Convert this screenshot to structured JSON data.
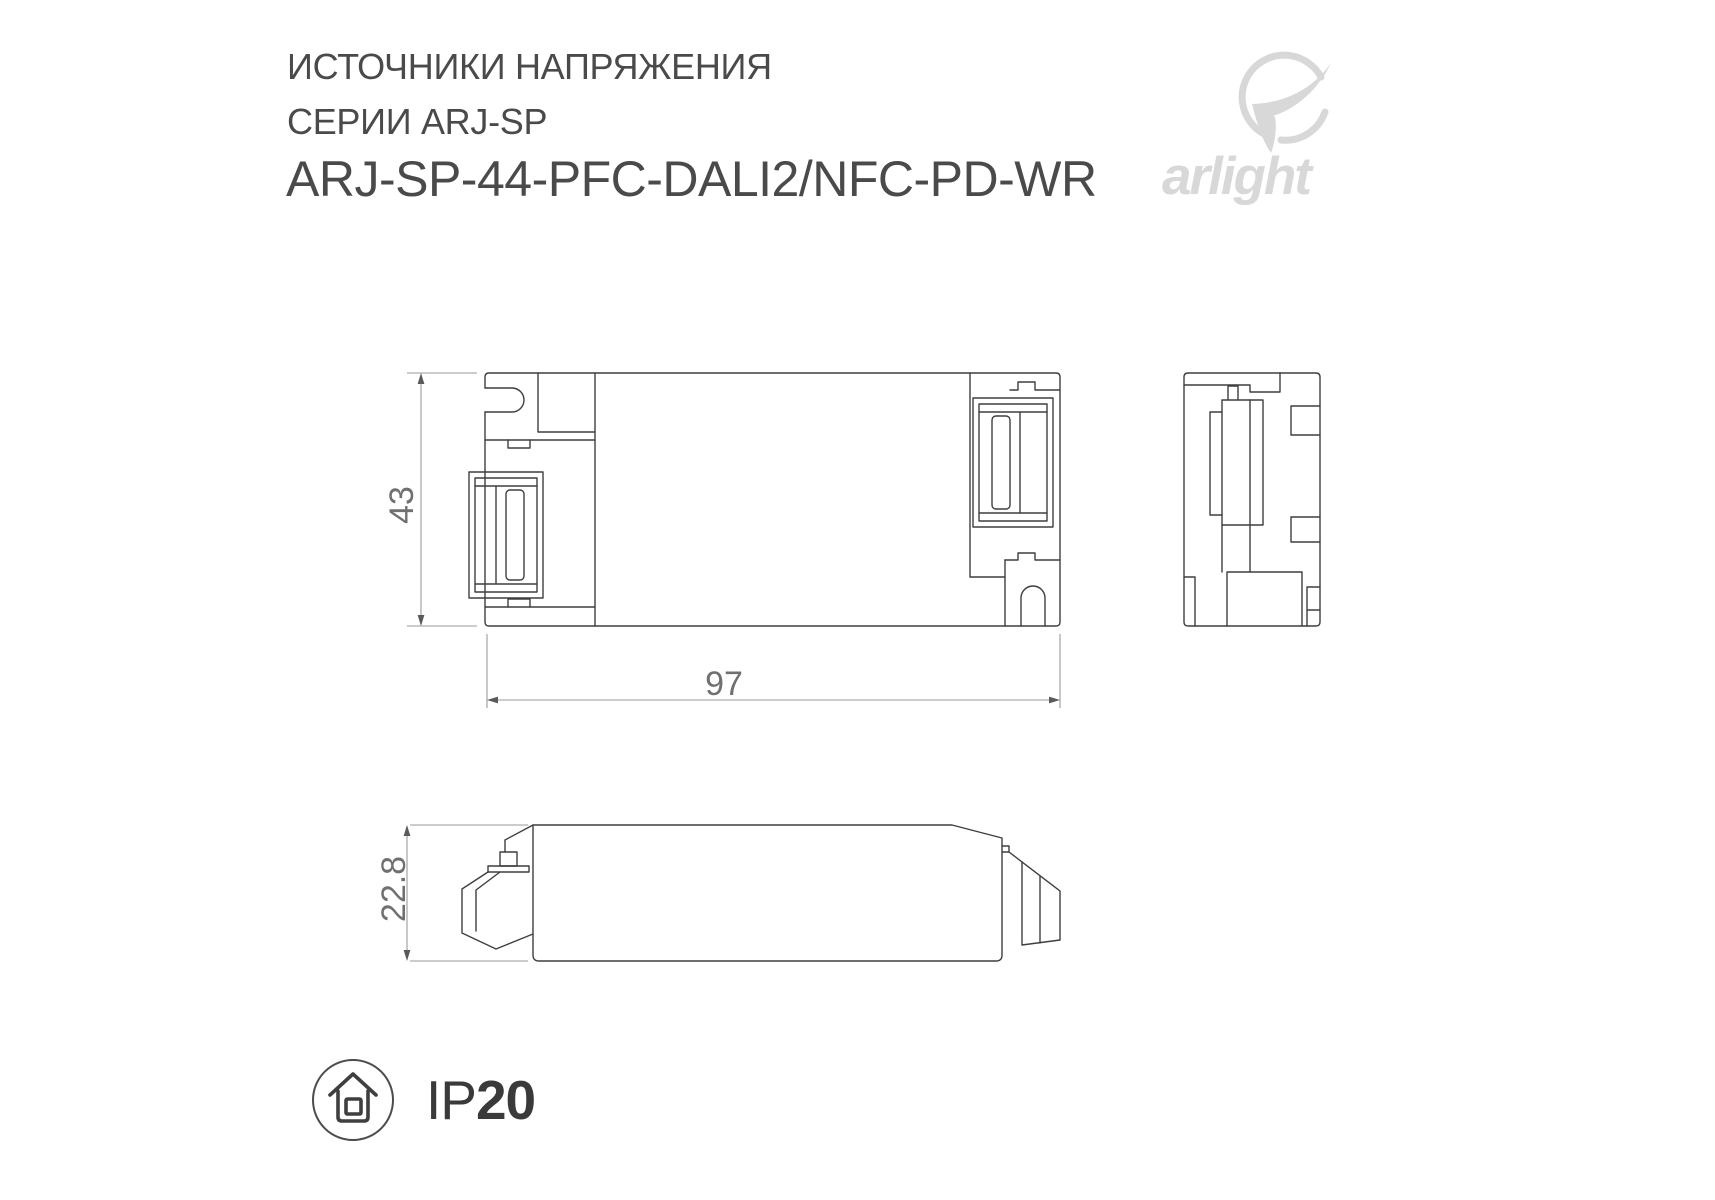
{
  "colors": {
    "drawing_line": "#3f3f3f",
    "dimension_line": "#9a9a9a",
    "dimension_text": "#707070",
    "title_text": "#4a4a4a",
    "logo_gray": "#d8d8d8",
    "ip_text": "#3a3a3a"
  },
  "header": {
    "title_line1": "ИСТОЧНИКИ НАПРЯЖЕНИЯ",
    "title_line2": "СЕРИИ ARJ-SP",
    "title_line3": "ARJ-SP-44-PFC-DALI2/NFC-PD-WR"
  },
  "logo": {
    "wordmark": "arlight",
    "icon": "arlight-swoosh-icon"
  },
  "drawing": {
    "dim_height": "43",
    "dim_length": "97",
    "dim_depth": "22.8"
  },
  "ip_rating": {
    "prefix": "IP",
    "value": "20",
    "icon": "house-in-circle-icon"
  }
}
